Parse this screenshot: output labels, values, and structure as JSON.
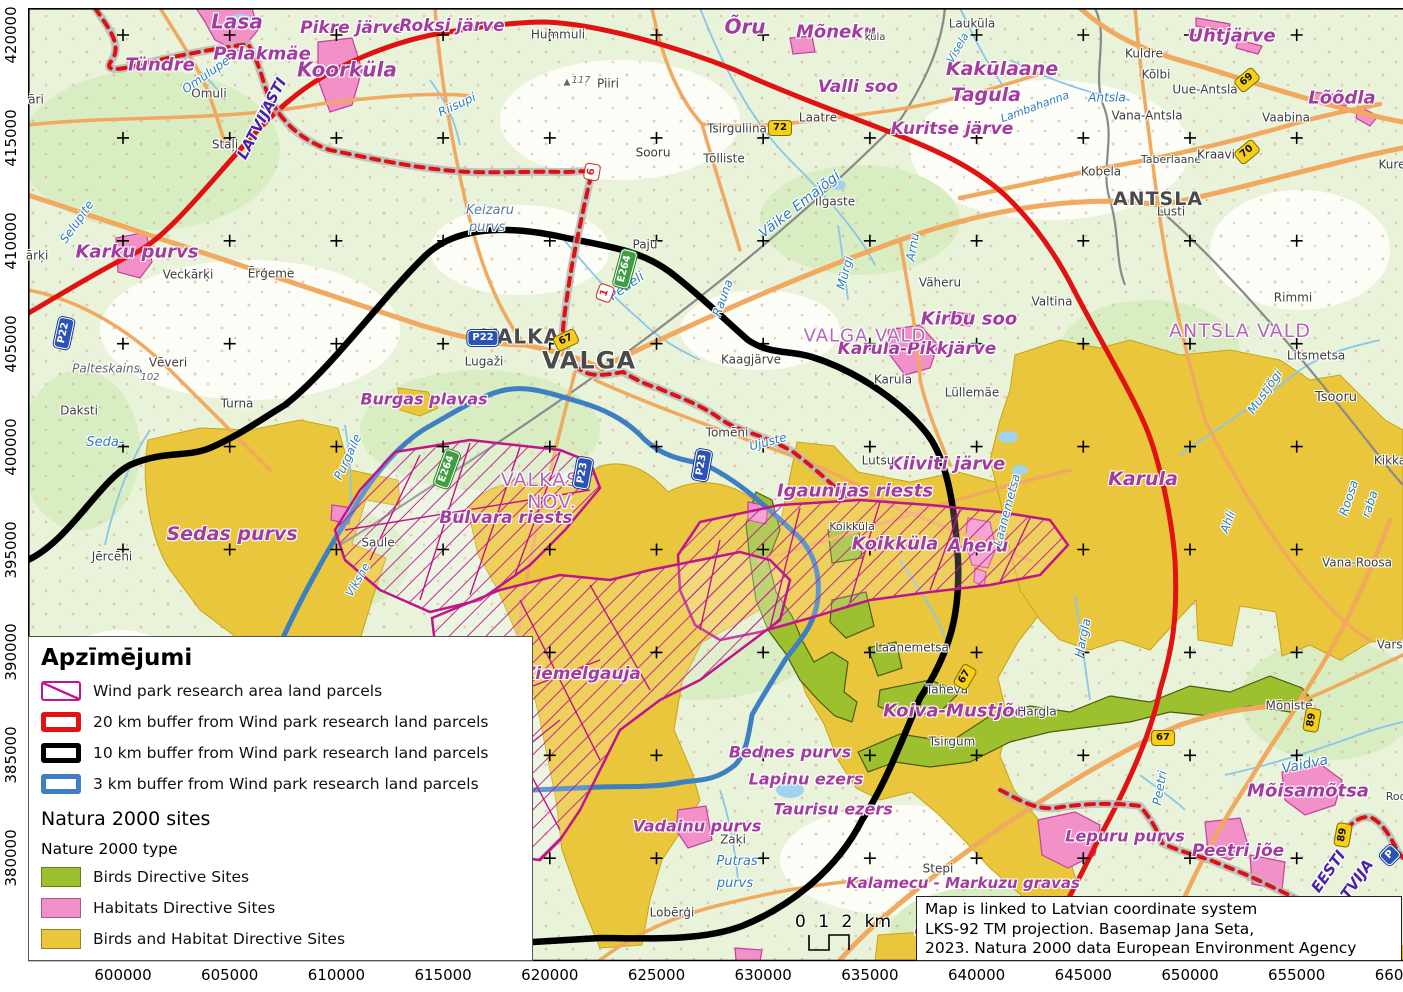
{
  "colors": {
    "buffer20": "#e01212",
    "buffer10": "#000000",
    "buffer3": "#3d7fc1",
    "parcels": "#c0158c",
    "birds": "#9dc02f",
    "habitats": "#f291c8",
    "birds_habitat": "#e9c63b",
    "basemap": "#e8f3da",
    "roads": "#f0a95e",
    "water": "#8ac6ea"
  },
  "legend": {
    "title": "Apzīmējumi",
    "buffer_items": [
      {
        "label": "Wind park research area land parcels",
        "swatch": "hatch"
      },
      {
        "label": "20 km buffer from Wind park research land parcels",
        "swatch": "outline",
        "color": "#e01212"
      },
      {
        "label": "10 km buffer from Wind park research land parcels",
        "swatch": "outline",
        "color": "#000000"
      },
      {
        "label": "3 km buffer from Wind park research land parcels",
        "swatch": "outline",
        "color": "#3d7fc1"
      }
    ],
    "natura_title": "Natura 2000 sites",
    "natura_subtitle": "Nature 2000 type",
    "natura_items": [
      {
        "label": "Birds Directive Sites",
        "color": "#9dc02f"
      },
      {
        "label": "Habitats Directive Sites",
        "color": "#f291c8"
      },
      {
        "label": "Birds and Habitat Directive Sites",
        "color": "#e9c63b"
      }
    ]
  },
  "infobox": {
    "lines": [
      "Map is linked to Latvian coordinate system",
      "LKS-92 TM projection. Basemap Jana Seta,",
      "2023. Natura 2000 data European Environment Agency"
    ]
  },
  "scalebar": {
    "label": "0 1 2 km"
  },
  "axes": {
    "x": {
      "labels": [
        "600000",
        "605000",
        "610000",
        "615000",
        "620000",
        "625000",
        "630000",
        "635000",
        "640000",
        "645000",
        "650000",
        "655000",
        "660000"
      ],
      "start": 123,
      "step": 106.7,
      "y": 975
    },
    "y": {
      "labels": [
        "420000",
        "415000",
        "410000",
        "405000",
        "400000",
        "395000",
        "390000",
        "385000",
        "380000"
      ],
      "start": 35,
      "step": 102.9,
      "x": 11
    }
  },
  "map": {
    "crosses": {
      "x0": 123,
      "dx": 106.7,
      "nx": 12,
      "y0": 35,
      "dy": 102.9,
      "ny": 9
    },
    "labels": [
      {
        "t": "Tündre",
        "x": 160,
        "y": 66,
        "s": "n",
        "f": 18
      },
      {
        "t": "Lasa",
        "x": 237,
        "y": 22,
        "s": "n",
        "f": 20
      },
      {
        "t": "Pikre järve",
        "x": 352,
        "y": 29,
        "s": "n",
        "f": 17
      },
      {
        "t": "Roksi järve",
        "x": 452,
        "y": 27,
        "s": "n",
        "f": 17
      },
      {
        "t": "Palakmäe",
        "x": 262,
        "y": 55,
        "s": "n",
        "f": 18
      },
      {
        "t": "Koorküla",
        "x": 347,
        "y": 70,
        "s": "n",
        "f": 20
      },
      {
        "t": "Karku purvs",
        "x": 137,
        "y": 253,
        "s": "n",
        "f": 18
      },
      {
        "t": "Õru",
        "x": 745,
        "y": 27,
        "s": "n",
        "f": 20
      },
      {
        "t": "Mõneku",
        "x": 836,
        "y": 33,
        "s": "n",
        "f": 18
      },
      {
        "t": "Valli soo",
        "x": 858,
        "y": 88,
        "s": "n",
        "f": 17
      },
      {
        "t": "Kuritse järve",
        "x": 952,
        "y": 130,
        "s": "n",
        "f": 17
      },
      {
        "t": "Kakūlaane",
        "x": 1002,
        "y": 70,
        "s": "n",
        "f": 19
      },
      {
        "t": "Tagula",
        "x": 986,
        "y": 96,
        "s": "n",
        "f": 19
      },
      {
        "t": "Uhtjärve",
        "x": 1232,
        "y": 37,
        "s": "n",
        "f": 18
      },
      {
        "t": "Lõõdla",
        "x": 1342,
        "y": 99,
        "s": "n",
        "f": 18
      },
      {
        "t": "Kirbu soo",
        "x": 969,
        "y": 320,
        "s": "n",
        "f": 18
      },
      {
        "t": "Karula-Pikkjärve",
        "x": 917,
        "y": 350,
        "s": "n",
        "f": 17
      },
      {
        "t": "Kiiviti järve",
        "x": 947,
        "y": 465,
        "s": "n",
        "f": 18
      },
      {
        "t": "Igaunijas riests",
        "x": 855,
        "y": 492,
        "s": "n",
        "f": 18
      },
      {
        "t": "Koikküla",
        "x": 895,
        "y": 545,
        "s": "n",
        "f": 18
      },
      {
        "t": "Aheru",
        "x": 978,
        "y": 547,
        "s": "n",
        "f": 18
      },
      {
        "t": "Karula",
        "x": 1143,
        "y": 480,
        "s": "n",
        "f": 19
      },
      {
        "t": "Burgas plavas",
        "x": 424,
        "y": 400,
        "s": "n",
        "f": 16
      },
      {
        "t": "Bulvara riests",
        "x": 506,
        "y": 519,
        "s": "n",
        "f": 17
      },
      {
        "t": "Sedas purvs",
        "x": 232,
        "y": 535,
        "s": "n",
        "f": 19
      },
      {
        "t": "Ziemelgauja",
        "x": 582,
        "y": 675,
        "s": "n",
        "f": 17
      },
      {
        "t": "Koiva-Mustjõe",
        "x": 955,
        "y": 712,
        "s": "n",
        "f": 18
      },
      {
        "t": "Bednes purvs",
        "x": 790,
        "y": 753,
        "s": "n",
        "f": 16
      },
      {
        "t": "Lapinu ezers",
        "x": 806,
        "y": 780,
        "s": "n",
        "f": 16
      },
      {
        "t": "Taurisu ezers",
        "x": 833,
        "y": 810,
        "s": "n",
        "f": 16
      },
      {
        "t": "Vadainu purvs",
        "x": 697,
        "y": 827,
        "s": "n",
        "f": 16
      },
      {
        "t": "Kalamecu - Markuzu gravas",
        "x": 963,
        "y": 884,
        "s": "n",
        "f": 15
      },
      {
        "t": "Lepuru purvs",
        "x": 1125,
        "y": 837,
        "s": "n",
        "f": 16
      },
      {
        "t": "Peetri jõe",
        "x": 1238,
        "y": 852,
        "s": "n",
        "f": 17
      },
      {
        "t": "Mõisamõtsa",
        "x": 1308,
        "y": 792,
        "s": "n",
        "f": 18
      },
      {
        "t": "G",
        "x": 921,
        "y": 932,
        "s": "n",
        "f": 16
      },
      {
        "t": "VALKAS",
        "x": 540,
        "y": 481,
        "s": "a"
      },
      {
        "t": "NOV.",
        "x": 552,
        "y": 503,
        "s": "a"
      },
      {
        "t": "ANTSLA VALD",
        "x": 1240,
        "y": 332,
        "s": "a"
      },
      {
        "t": "VALGA VALD",
        "x": 865,
        "y": 337,
        "s": "a",
        "f": 18
      },
      {
        "t": "Hummuli",
        "x": 558,
        "y": 35,
        "s": "t"
      },
      {
        "t": "Omuli",
        "x": 209,
        "y": 94,
        "s": "t"
      },
      {
        "t": "Staļi",
        "x": 225,
        "y": 145,
        "s": "t"
      },
      {
        "t": "Piiri",
        "x": 608,
        "y": 84,
        "s": "t"
      },
      {
        "t": "▲",
        "x": 567,
        "y": 83,
        "s": "g",
        "f": 9
      },
      {
        "t": "117",
        "x": 581,
        "y": 81,
        "s": "g",
        "f": 10
      },
      {
        "t": "Sooru",
        "x": 653,
        "y": 153,
        "s": "t"
      },
      {
        "t": "Tsirguliina",
        "x": 737,
        "y": 129,
        "s": "t"
      },
      {
        "t": "Tõlliste",
        "x": 724,
        "y": 159,
        "s": "t"
      },
      {
        "t": "Laatre",
        "x": 818,
        "y": 118,
        "s": "t"
      },
      {
        "t": "küla",
        "x": 875,
        "y": 38,
        "s": "t",
        "f": 10
      },
      {
        "t": "Lauküla",
        "x": 972,
        "y": 24,
        "s": "t"
      },
      {
        "t": "Kuldre",
        "x": 1144,
        "y": 54,
        "s": "t"
      },
      {
        "t": "Kõlbi",
        "x": 1156,
        "y": 75,
        "s": "t"
      },
      {
        "t": "Uue-Antsla",
        "x": 1205,
        "y": 90,
        "s": "t"
      },
      {
        "t": "Vana-Antsla",
        "x": 1147,
        "y": 116,
        "s": "t"
      },
      {
        "t": "Vaabina",
        "x": 1286,
        "y": 118,
        "s": "t"
      },
      {
        "t": "Taberlaane",
        "x": 1171,
        "y": 160,
        "s": "t",
        "f": 11
      },
      {
        "t": "Kraavi",
        "x": 1216,
        "y": 155,
        "s": "t"
      },
      {
        "t": "Kobela",
        "x": 1101,
        "y": 172,
        "s": "t"
      },
      {
        "t": "ANTSLA",
        "x": 1158,
        "y": 200,
        "s": "T",
        "f": 19
      },
      {
        "t": "Lusti",
        "x": 1171,
        "y": 212,
        "s": "t"
      },
      {
        "t": "Kure",
        "x": 1392,
        "y": 165,
        "s": "t"
      },
      {
        "t": "āri",
        "x": 36,
        "y": 100,
        "s": "t"
      },
      {
        "t": "ārķi",
        "x": 37,
        "y": 256,
        "s": "t"
      },
      {
        "t": "Veckārķi",
        "x": 188,
        "y": 275,
        "s": "t"
      },
      {
        "t": "Ērģeme",
        "x": 271,
        "y": 274,
        "s": "t"
      },
      {
        "t": "Vēveri",
        "x": 168,
        "y": 363,
        "s": "t"
      },
      {
        "t": "▲",
        "x": 139,
        "y": 370,
        "s": "g",
        "f": 9
      },
      {
        "t": "102",
        "x": 150,
        "y": 378,
        "s": "g",
        "f": 10
      },
      {
        "t": "Palteskains",
        "x": 106,
        "y": 369,
        "s": "g",
        "f": 12
      },
      {
        "t": "Turna",
        "x": 237,
        "y": 404,
        "s": "t"
      },
      {
        "t": "Daksti",
        "x": 79,
        "y": 411,
        "s": "t"
      },
      {
        "t": "Jērcēni",
        "x": 112,
        "y": 557,
        "s": "t"
      },
      {
        "t": "Saule",
        "x": 378,
        "y": 543,
        "s": "t"
      },
      {
        "t": "Lugaži",
        "x": 484,
        "y": 362,
        "s": "t"
      },
      {
        "t": "VALKA",
        "x": 521,
        "y": 337,
        "s": "T",
        "f": 20
      },
      {
        "t": "VALGA",
        "x": 589,
        "y": 361,
        "s": "T",
        "f": 24
      },
      {
        "t": "Kaagjärve",
        "x": 751,
        "y": 360,
        "s": "t"
      },
      {
        "t": "Tomēni",
        "x": 727,
        "y": 433,
        "s": "t"
      },
      {
        "t": "Lutsu",
        "x": 878,
        "y": 461,
        "s": "t"
      },
      {
        "t": "Karula",
        "x": 893,
        "y": 380,
        "s": "t"
      },
      {
        "t": "Lüllemäe",
        "x": 972,
        "y": 393,
        "s": "t"
      },
      {
        "t": "Valtina",
        "x": 1052,
        "y": 302,
        "s": "t"
      },
      {
        "t": "Koikküla",
        "x": 852,
        "y": 527,
        "s": "t",
        "f": 11
      },
      {
        "t": "Laanemetsa",
        "x": 912,
        "y": 648,
        "s": "t"
      },
      {
        "t": "Taheva",
        "x": 947,
        "y": 690,
        "s": "t"
      },
      {
        "t": "Hargla",
        "x": 1037,
        "y": 712,
        "s": "t"
      },
      {
        "t": "Tsirgum",
        "x": 952,
        "y": 742,
        "s": "t"
      },
      {
        "t": "Zaķi",
        "x": 733,
        "y": 840,
        "s": "t"
      },
      {
        "t": "Stepi",
        "x": 938,
        "y": 869,
        "s": "t"
      },
      {
        "t": "Lobērģi",
        "x": 672,
        "y": 913,
        "s": "t"
      },
      {
        "t": "Mõniste",
        "x": 1289,
        "y": 706,
        "s": "t"
      },
      {
        "t": "Varst",
        "x": 1392,
        "y": 645,
        "s": "t"
      },
      {
        "t": "Rimmi",
        "x": 1293,
        "y": 298,
        "s": "t"
      },
      {
        "t": "Litsmetsa",
        "x": 1316,
        "y": 356,
        "s": "t"
      },
      {
        "t": "Tsooru",
        "x": 1336,
        "y": 398,
        "s": "t",
        "f": 13
      },
      {
        "t": "Kikka",
        "x": 1390,
        "y": 461,
        "s": "t"
      },
      {
        "t": "Vana-Roosa",
        "x": 1357,
        "y": 563,
        "s": "t"
      },
      {
        "t": "Roo",
        "x": 1396,
        "y": 797,
        "s": "t",
        "f": 11
      },
      {
        "t": "Paju",
        "x": 645,
        "y": 245,
        "s": "t"
      },
      {
        "t": "Ilgaste",
        "x": 835,
        "y": 202,
        "s": "t"
      },
      {
        "t": "Väheru",
        "x": 940,
        "y": 283,
        "s": "t"
      },
      {
        "t": "Omulupe",
        "x": 206,
        "y": 75,
        "s": "r",
        "r": -35
      },
      {
        "t": "Riisupi",
        "x": 457,
        "y": 105,
        "s": "r",
        "r": -25
      },
      {
        "t": "Keizaru",
        "x": 490,
        "y": 211,
        "s": "q"
      },
      {
        "t": "purvs",
        "x": 487,
        "y": 228,
        "s": "q"
      },
      {
        "t": "Pedeli",
        "x": 627,
        "y": 287,
        "s": "r",
        "r": -35,
        "f": 13
      },
      {
        "t": "Väike Emajõgi",
        "x": 800,
        "y": 205,
        "s": "r",
        "r": -38,
        "f": 14
      },
      {
        "t": "Mürgi",
        "x": 845,
        "y": 273,
        "s": "r",
        "r": -75
      },
      {
        "t": "Arnu",
        "x": 913,
        "y": 247,
        "s": "r",
        "r": -80
      },
      {
        "t": "Rauna",
        "x": 723,
        "y": 298,
        "s": "r",
        "r": -70
      },
      {
        "t": "Ujuste",
        "x": 768,
        "y": 442,
        "s": "r",
        "r": -15
      },
      {
        "t": "Seda-",
        "x": 105,
        "y": 443,
        "s": "r",
        "f": 13
      },
      {
        "t": "Selupite",
        "x": 77,
        "y": 222,
        "s": "r",
        "r": -55
      },
      {
        "t": "Purgaile",
        "x": 348,
        "y": 457,
        "s": "r",
        "r": -65
      },
      {
        "t": "Viksne",
        "x": 358,
        "y": 580,
        "s": "r",
        "r": -60,
        "f": 11
      },
      {
        "t": "Laanemetsa",
        "x": 1007,
        "y": 510,
        "s": "r",
        "r": -75
      },
      {
        "t": "Mustjõgi",
        "x": 1265,
        "y": 392,
        "s": "r",
        "r": -55
      },
      {
        "t": "Roosa",
        "x": 1349,
        "y": 498,
        "s": "r",
        "r": -72
      },
      {
        "t": "raba",
        "x": 1370,
        "y": 504,
        "s": "r",
        "r": -72
      },
      {
        "t": "Vaidva",
        "x": 1305,
        "y": 765,
        "s": "r",
        "r": -12,
        "f": 14
      },
      {
        "t": "Hargla",
        "x": 1083,
        "y": 638,
        "s": "r",
        "r": -78
      },
      {
        "t": "Putras",
        "x": 737,
        "y": 862,
        "s": "r",
        "f": 13
      },
      {
        "t": "purvs",
        "x": 735,
        "y": 884,
        "s": "r",
        "f": 13
      },
      {
        "t": "Peetri",
        "x": 1160,
        "y": 788,
        "s": "r",
        "r": -80
      },
      {
        "t": "Lambahanna",
        "x": 1035,
        "y": 107,
        "s": "r",
        "r": -20,
        "f": 11
      },
      {
        "t": "Antsla",
        "x": 1107,
        "y": 98,
        "s": "r"
      },
      {
        "t": "Ahli",
        "x": 1228,
        "y": 522,
        "s": "r",
        "r": -70
      },
      {
        "t": "Visela",
        "x": 958,
        "y": 48,
        "s": "r",
        "r": -60,
        "f": 11
      },
      {
        "t": "EESTI",
        "x": 272,
        "y": 100,
        "s": "b",
        "r": -62
      },
      {
        "t": "LATVIJA",
        "x": 257,
        "y": 130,
        "s": "b",
        "r": -62
      },
      {
        "t": "EESTI",
        "x": 1329,
        "y": 872,
        "s": "b",
        "r": -55
      },
      {
        "t": "LATVIJA",
        "x": 1352,
        "y": 888,
        "s": "b",
        "r": -55
      }
    ],
    "shields": [
      {
        "t": "P22",
        "x": 483,
        "y": 338,
        "c": "blue"
      },
      {
        "t": "P22",
        "x": 64,
        "y": 333,
        "c": "blue",
        "r": -78
      },
      {
        "t": "67",
        "x": 566,
        "y": 340,
        "c": "yellow",
        "r": -25
      },
      {
        "t": "72",
        "x": 780,
        "y": 128,
        "c": "yellow"
      },
      {
        "t": "69",
        "x": 1247,
        "y": 80,
        "c": "yellow",
        "r": -40
      },
      {
        "t": "70",
        "x": 1247,
        "y": 152,
        "c": "yellow",
        "r": -40
      },
      {
        "t": "6",
        "x": 592,
        "y": 172,
        "c": "red",
        "r": -80
      },
      {
        "t": "1",
        "x": 605,
        "y": 293,
        "c": "red",
        "r": -70
      },
      {
        "t": "E264",
        "x": 447,
        "y": 469,
        "c": "green",
        "r": -70
      },
      {
        "t": "E264",
        "x": 625,
        "y": 269,
        "c": "green",
        "r": -75
      },
      {
        "t": "P23",
        "x": 702,
        "y": 465,
        "c": "blue",
        "r": -80
      },
      {
        "t": "P23",
        "x": 583,
        "y": 473,
        "c": "blue",
        "r": -80
      },
      {
        "t": "67",
        "x": 965,
        "y": 677,
        "c": "yellow",
        "r": -60
      },
      {
        "t": "67",
        "x": 1163,
        "y": 738,
        "c": "yellow"
      },
      {
        "t": "89",
        "x": 1312,
        "y": 720,
        "c": "yellow",
        "r": -80
      },
      {
        "t": "89",
        "x": 1343,
        "y": 835,
        "c": "yellow",
        "r": -80
      },
      {
        "t": "P",
        "x": 1390,
        "y": 855,
        "c": "blue",
        "r": -45
      }
    ]
  }
}
